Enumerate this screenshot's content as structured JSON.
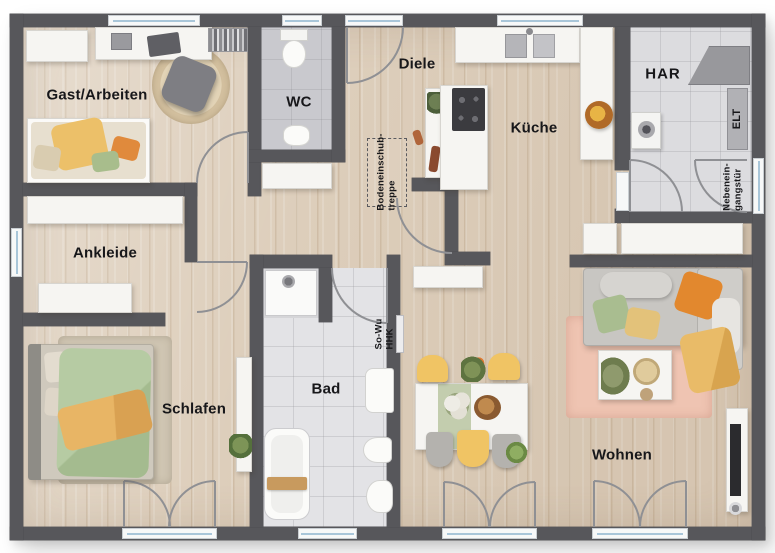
{
  "rooms": {
    "gast": "Gast/Arbeiten",
    "wc": "WC",
    "diele": "Diele",
    "kueche": "Küche",
    "har": "HAR",
    "ankleide": "Ankleide",
    "schlafen": "Schlafen",
    "bad": "Bad",
    "wohnen": "Wohnen"
  },
  "annotations": {
    "bodentreppe_line1": "Bodeneinschub-",
    "bodentreppe_line2": "treppe",
    "nebeneingang_line1": "Nebenein-",
    "nebeneingang_line2": "gangstür",
    "elt": "ELT",
    "sowu_line1": "So-Wu",
    "sowu_line2": "HHK"
  },
  "colors": {
    "wall": "#57575b",
    "floor_wood": "#ddcebb",
    "tile_wc": "#c9c9ce",
    "tile_har": "#dcdcdf",
    "tile_bad": "#e3e3e6",
    "window_glass": "#a9c6d9",
    "door_arc": "#8f9094",
    "rug_pink": "#efc4b2",
    "rug_round": "#d9c7a8",
    "sofa_gray": "#c8c6c2",
    "accent_orange": "#e2882e",
    "accent_yellow": "#e9c069",
    "accent_green": "#a9bd90",
    "label_text": "#17171a"
  }
}
